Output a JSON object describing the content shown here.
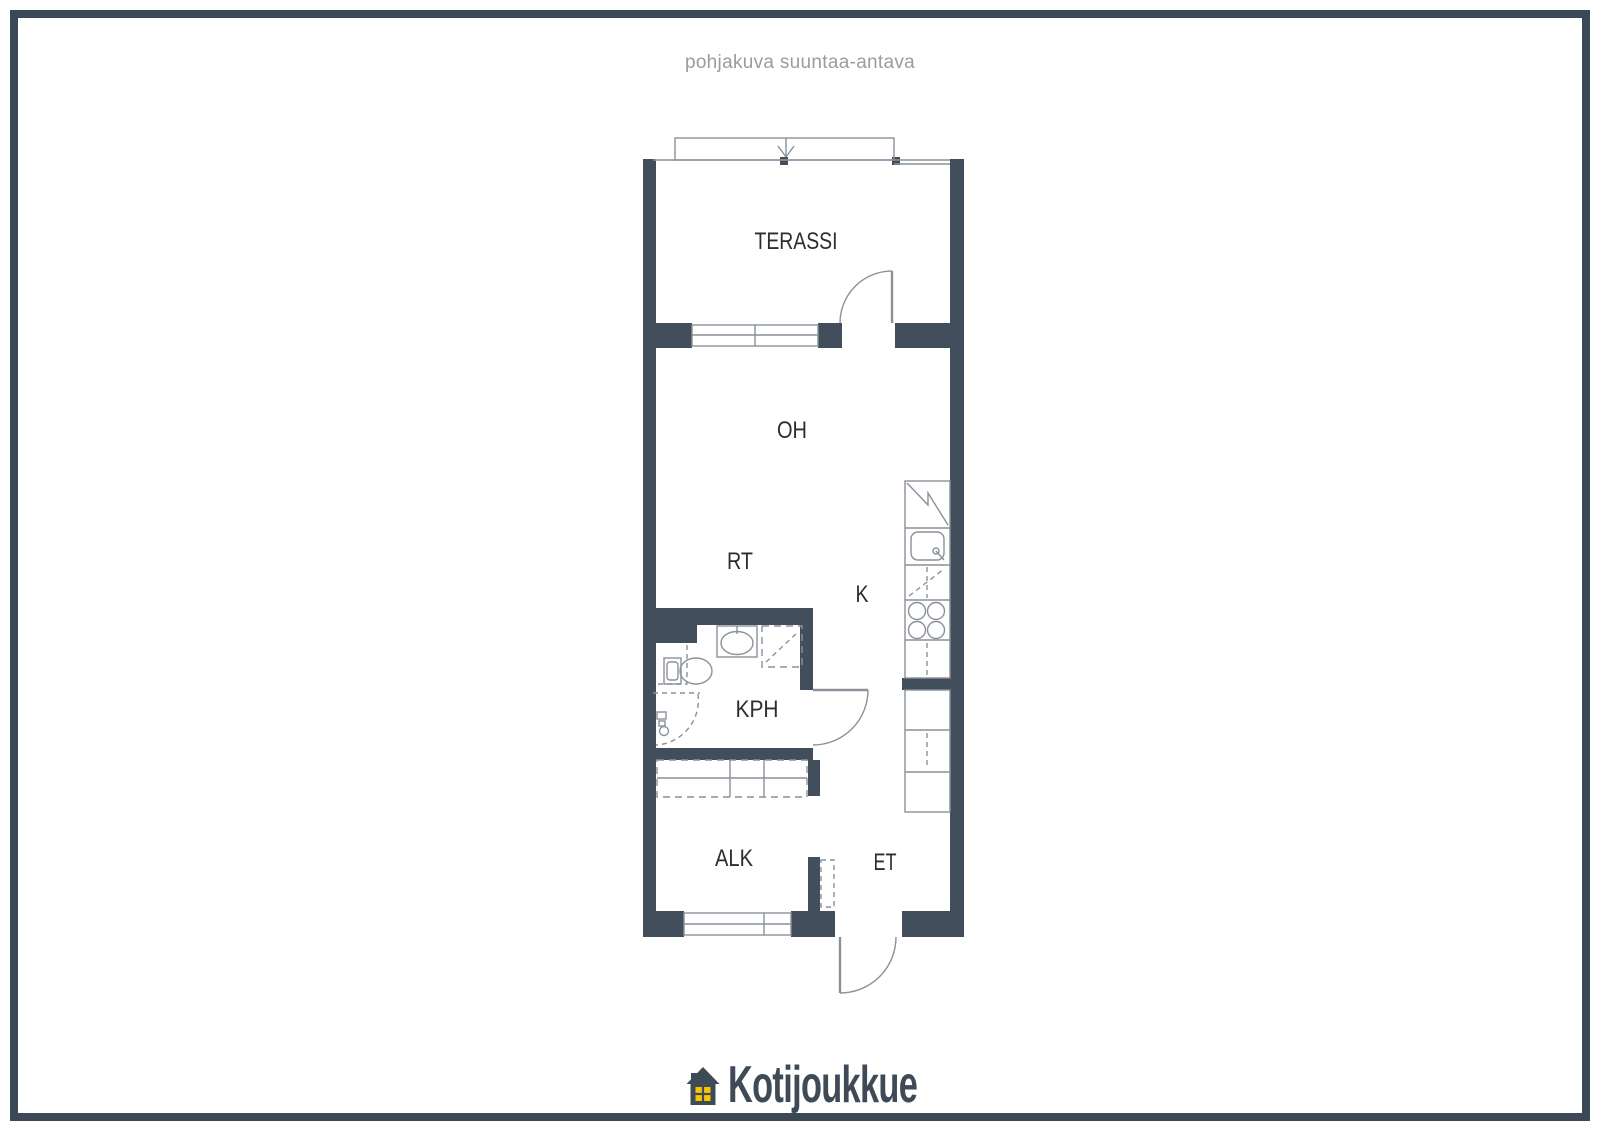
{
  "title": "pohjakuva suuntaa-antava",
  "plan": {
    "rooms": {
      "terassi": "TERASSI",
      "oh": "OH",
      "rt": "RT",
      "k": "K",
      "kph": "KPH",
      "alk": "ALK",
      "et": "ET"
    },
    "fixtures": [
      "terrace-railing",
      "direction-arrow",
      "terrace-door",
      "living-room-window",
      "refrigerator",
      "kitchen-sink",
      "dishwasher",
      "stove-cooktop",
      "kitchen-cabinets",
      "bathroom-door",
      "washbasin",
      "toilet",
      "shower",
      "shower-door-swing",
      "wardrobes",
      "alcove-window",
      "entrance-door",
      "utility-cabinet"
    ]
  },
  "logo": {
    "brand": "Kotijoukkue"
  },
  "colors": {
    "wall": "#424e5c",
    "line": "#8a9199",
    "label": "#2d2d2d",
    "title": "#9c9c9c",
    "frame": "#3c4856",
    "background": "#ffffff",
    "logo_text": "#3e4a56",
    "logo_window": "#f6c600"
  }
}
